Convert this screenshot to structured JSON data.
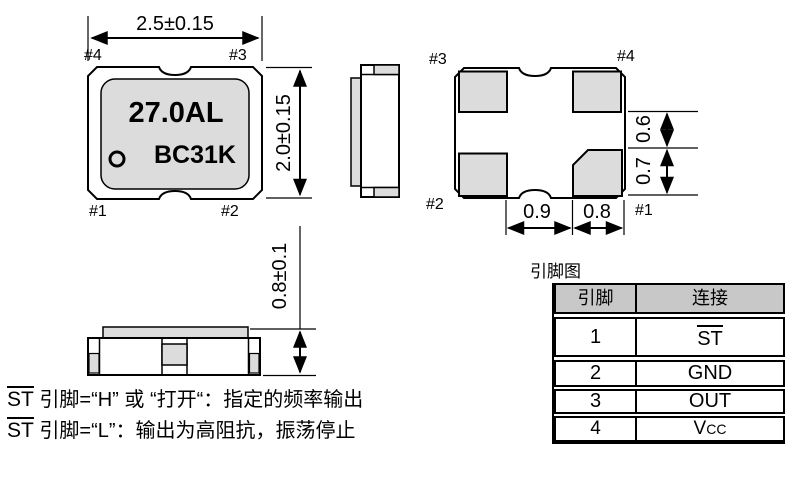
{
  "top_view": {
    "dim_width": "2.5±0.15",
    "dim_height": "2.0±0.15",
    "pin_top_left": "#4",
    "pin_top_right": "#3",
    "pin_bottom_left": "#1",
    "pin_bottom_right": "#2",
    "marking_line1": "27.0AL",
    "marking_line2": "BC31K"
  },
  "bottom_view": {
    "pin_top_left": "#3",
    "pin_top_right": "#4",
    "pin_bottom_left": "#2",
    "pin_bottom_right": "#1",
    "dim_pad_gap_vertical": "0.6",
    "dim_pad_height": "0.7",
    "dim_pad_gap_horizontal": "0.9",
    "dim_pad_width": "0.8"
  },
  "side_view": {
    "dim_height": "0.8±0.1"
  },
  "pin_table": {
    "title": "引脚图",
    "header_pin": "引脚",
    "header_connection": "连接",
    "rows": [
      {
        "pin": "1",
        "conn": "ST"
      },
      {
        "pin": "2",
        "conn": "GND"
      },
      {
        "pin": "3",
        "conn": "OUT"
      },
      {
        "pin": "4",
        "conn": "V",
        "conn_sub": "CC"
      }
    ]
  },
  "notes": [
    {
      "signal": "ST",
      "text": " 引脚=“H” 或 “打开“：指定的频率输出"
    },
    {
      "signal": "ST",
      "text": " 引脚=“L”：输出为高阻抗，振荡停止"
    }
  ],
  "colors": {
    "fill_gray": "#dcdcdc",
    "table_header_gray": "#c8c8c8",
    "line_black": "#000000"
  }
}
